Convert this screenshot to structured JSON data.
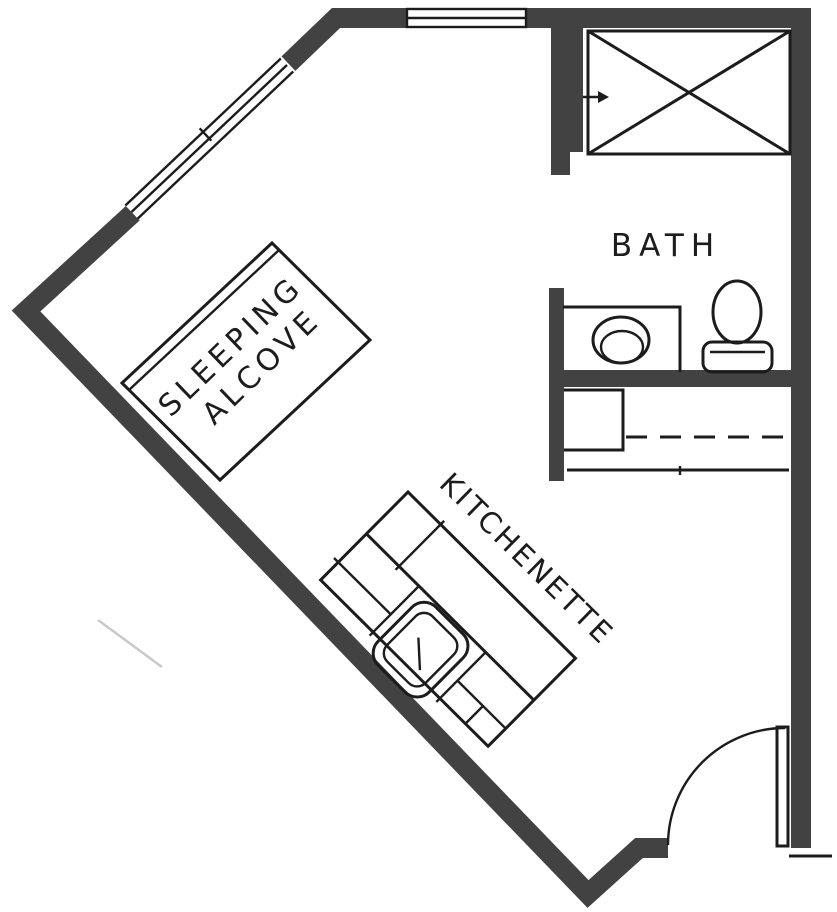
{
  "title": "Studio apartment floor plan",
  "labels": {
    "bath": "BATH",
    "sleeping_line1": "SLEEPING",
    "sleeping_line2": "ALCOVE",
    "kitchenette": "KITCHENETTE"
  },
  "colors": {
    "wall": "#424242",
    "line": "#1c1c1c",
    "background": "#ffffff",
    "artifact": "#c9c9c9"
  }
}
